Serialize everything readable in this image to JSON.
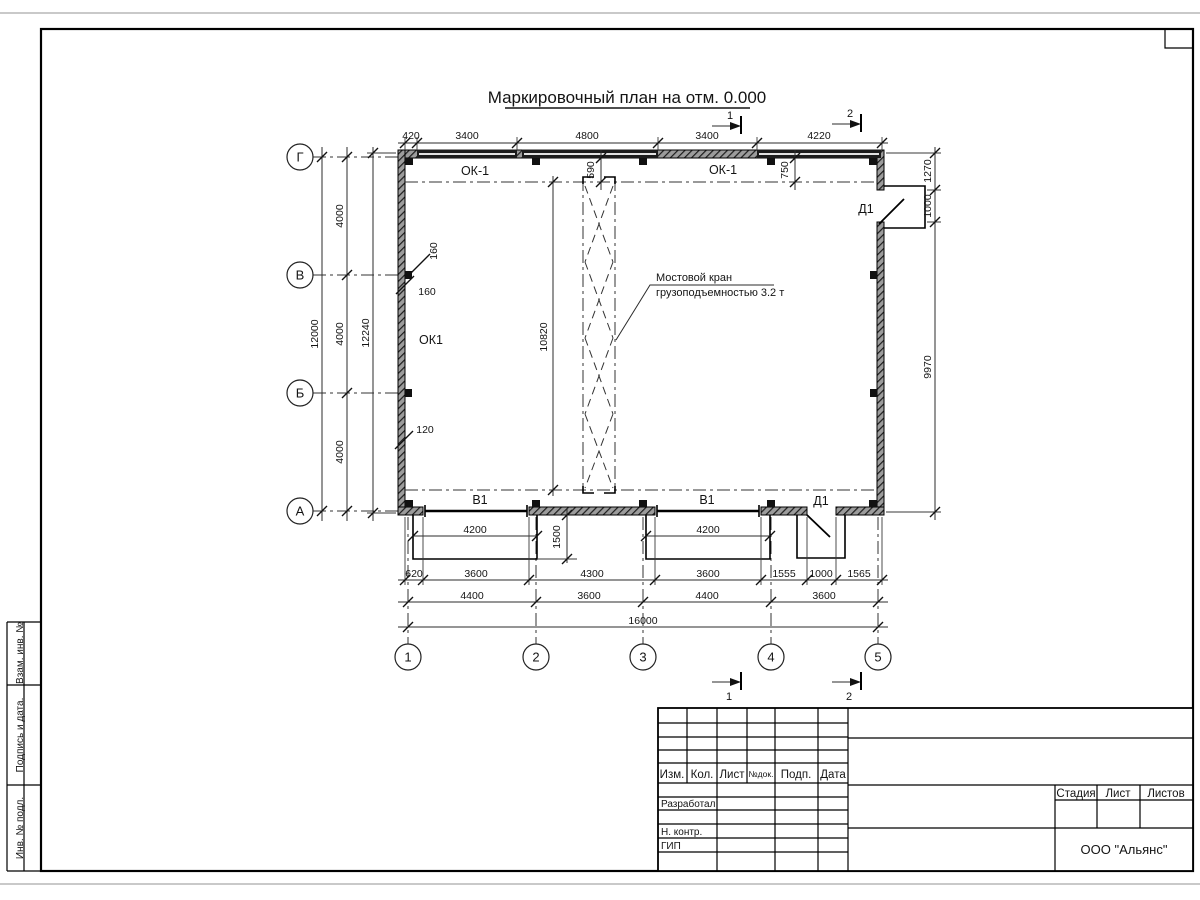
{
  "sheet": {
    "title": "Маркировочный план на отм. 0.000",
    "company": "ООО \"Альянс\""
  },
  "plan": {
    "axis_rows": [
      "Г",
      "В",
      "Б",
      "А"
    ],
    "axis_cols": [
      "1",
      "2",
      "3",
      "4",
      "5"
    ],
    "marks": {
      "window_top_left": "ОК-1",
      "window_top_right": "ОК-1",
      "window_left_wall": "ОК1",
      "door_top": "Д1",
      "door_bottom": "Д1",
      "gate_left": "В1",
      "gate_right": "В1"
    },
    "crane_note": [
      "Мостовой кран",
      "грузоподъемностью 3.2 т"
    ],
    "sections": {
      "s1": "1",
      "s2": "2"
    }
  },
  "dims": {
    "top": [
      "420",
      "3400",
      "4800",
      "3400",
      "4220"
    ],
    "left_total": "12000",
    "left_bays": [
      "4000",
      "4000",
      "4000"
    ],
    "left_overall": "12240",
    "right": [
      "1270",
      "1000",
      "9970"
    ],
    "bottom_row1": [
      "4200",
      "4200"
    ],
    "bottom_row2": [
      "620",
      "3600",
      "4300",
      "3600",
      "1555",
      "1000",
      "1565"
    ],
    "bottom_row3": [
      "4400",
      "3600",
      "4400",
      "3600"
    ],
    "bottom_total": "16000",
    "pit_depth": "1500",
    "crane_span": "10820",
    "crane_offset_left": "590",
    "crane_offset_right": "750",
    "pilaster_1": "160",
    "pilaster_2": "160",
    "wall_offset": "120"
  },
  "title_block": {
    "header_cols": [
      "Изм.",
      "Кол.",
      "Лист",
      "№док.",
      "Подп.",
      "Дата"
    ],
    "row_labels": [
      "Разработал",
      "Н. контр.",
      "ГИП"
    ],
    "stage_cols": [
      "Стадия",
      "Лист",
      "Листов"
    ]
  },
  "side_stamp": [
    "Взам. инв. №",
    "Подпись  и  дата.",
    "Инв. № подл."
  ]
}
